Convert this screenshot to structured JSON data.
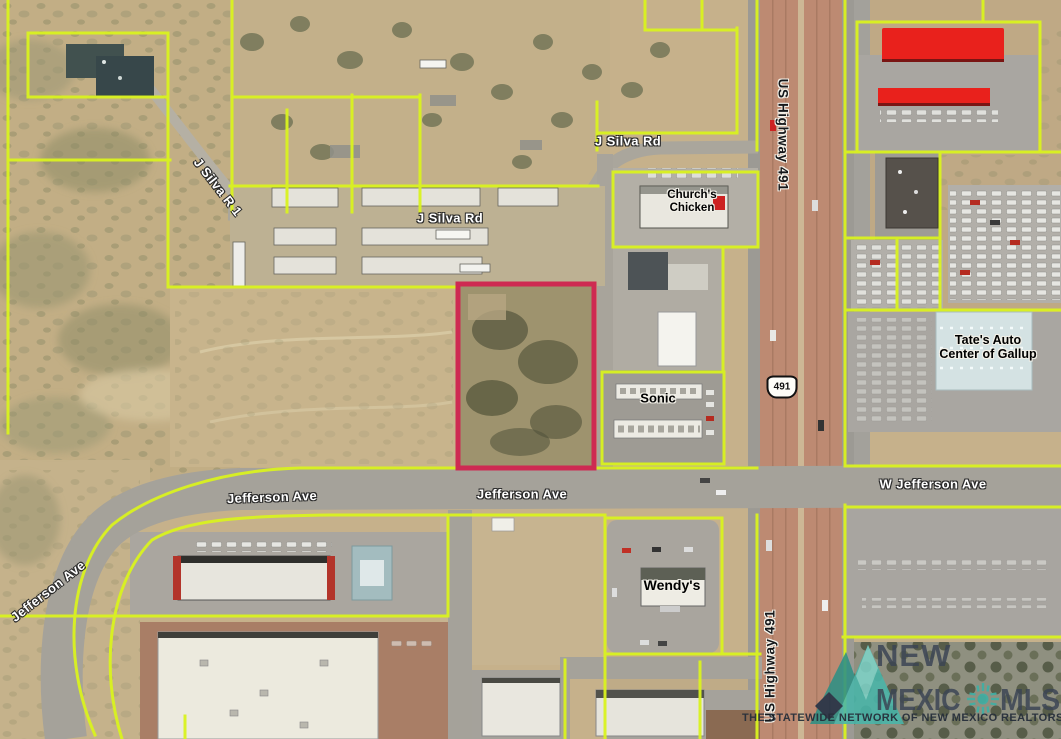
{
  "map": {
    "kind": "aerial-parcel-map",
    "colors": {
      "parcel_boundary": "#daf31f",
      "highlighted_parcel": "#ce2a52",
      "highway_pavement": "#bd8a72",
      "road_pavement": "#a5a29a",
      "desert_ground": "#c6b18b"
    }
  },
  "labels": {
    "j_silva_rd_upper": "J Silva Rd",
    "j_silva_rd_lower": "J Silva Rd",
    "j_silva_r_1": "J Silva R 1",
    "us_highway_491_upper": "US Highway 491",
    "us_highway_491_lower": "US Highway 491",
    "jefferson_ave_west": "Jefferson Ave",
    "jefferson_ave_center": "Jefferson Ave",
    "jefferson_ave_curve": "Jefferson Ave",
    "w_jefferson_ave": "W Jefferson Ave",
    "route_shield_491": "491",
    "churchs_chicken_line1": "Church's",
    "churchs_chicken_line2": "Chicken",
    "sonic": "Sonic",
    "wendys": "Wendy's",
    "tates_auto_line1": "Tate's Auto",
    "tates_auto_line2": "Center of Gallup"
  },
  "watermark": {
    "brand_line1": "NEW",
    "brand_line2_left": "MEXIC",
    "brand_line2_right": "MLS",
    "tagline": "THE STATEWIDE NETWORK OF NEW MEXICO REALTORS®",
    "accent_teal": "#45b2a7",
    "text_color": "#3a4454"
  }
}
